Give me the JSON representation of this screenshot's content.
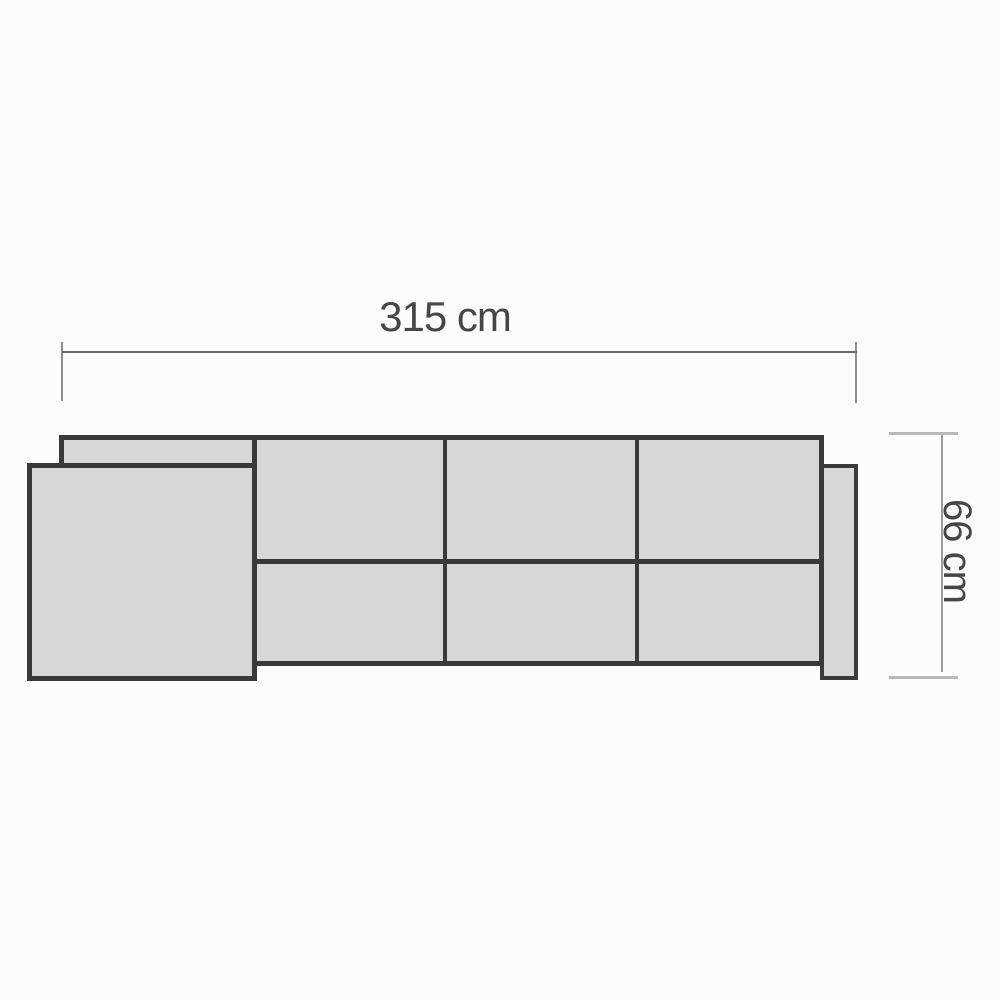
{
  "diagram": {
    "title": "corner-sofa-top-view-dimension-drawing",
    "dimensions": {
      "width": {
        "label": "315 cm"
      },
      "depth": {
        "label": "66 cm"
      }
    },
    "parts": {
      "sofa_body": "three-section sofa body with back cushion row and seat cushion row",
      "chaise": "left chaise / corner section overlapping body",
      "armrest": "right armrest panel"
    },
    "colors": {
      "page_bg": "#fcfcfc",
      "cushion_fill": "#d8d8d8",
      "outline": "#3a3a3a",
      "width_dim_line": "#6e6e6e",
      "width_dim_tick": "#8f8f8f",
      "depth_dim_line": "#9b9b9b",
      "depth_dim_tick": "#b9b9b9",
      "label_text": "#464646"
    }
  }
}
